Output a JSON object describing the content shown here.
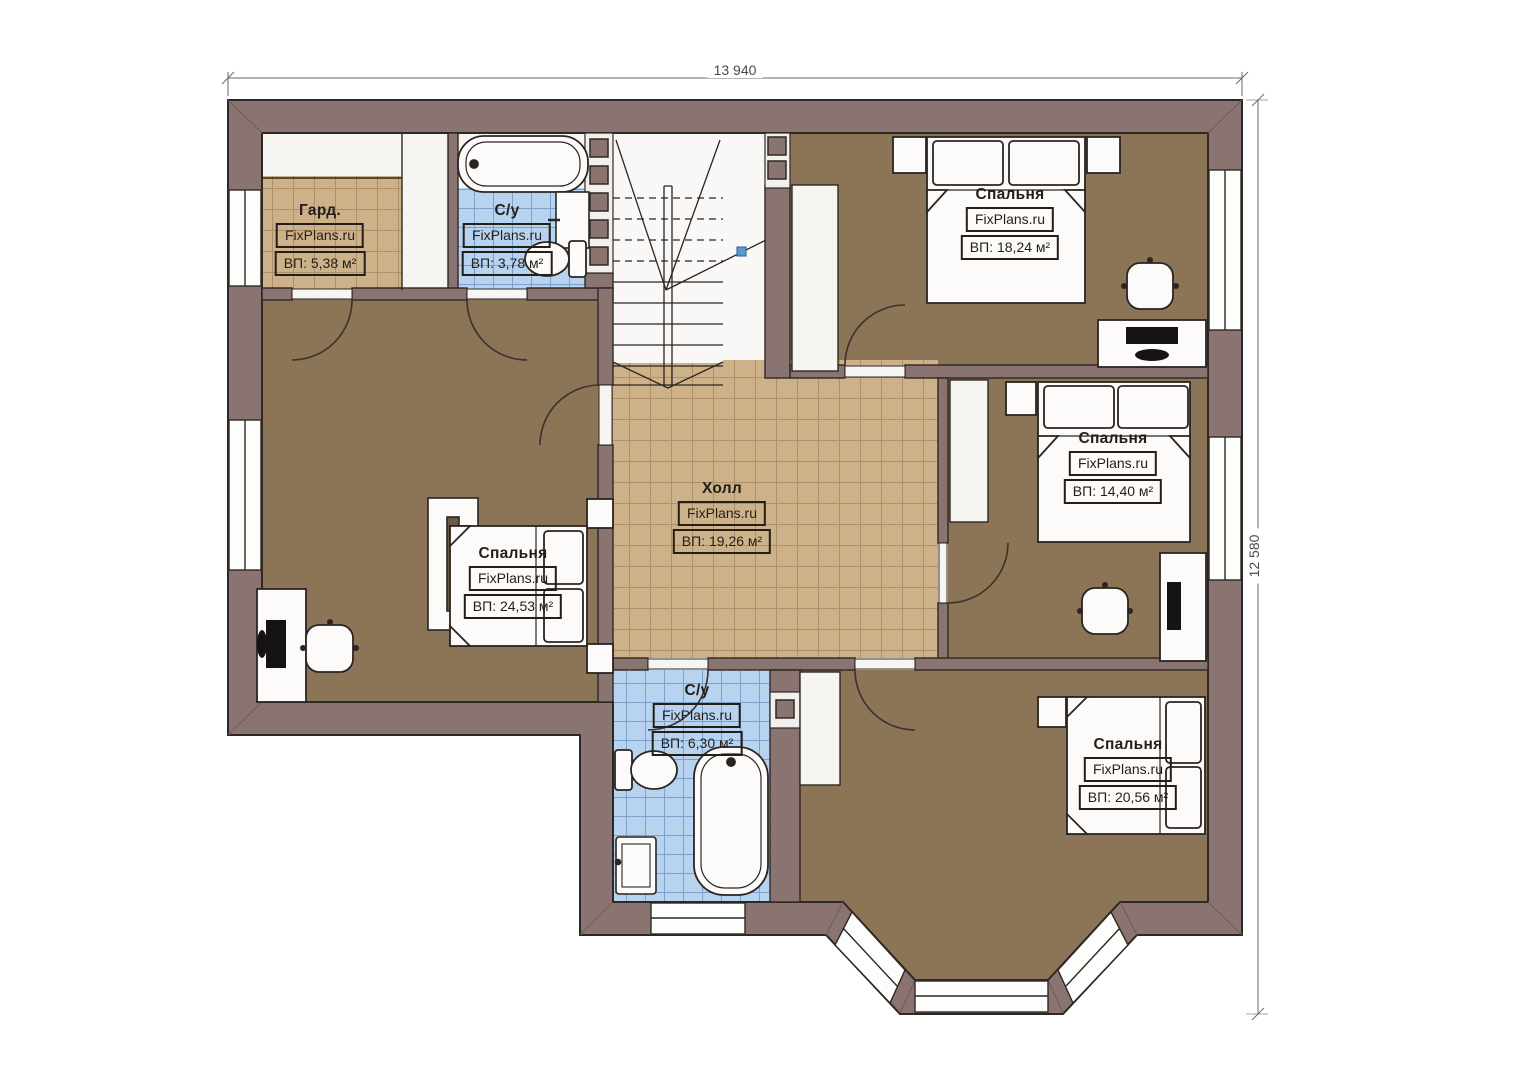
{
  "plan": {
    "watermark": "FixPlans.ru",
    "dimensions": {
      "width": "13 940",
      "height": "12 580"
    },
    "rooms": [
      {
        "name": "Гард.",
        "area": "ВП: 5,38 м²"
      },
      {
        "name": "С/у",
        "area": "ВП: 3,78 м²"
      },
      {
        "name": "Спальня",
        "area": "ВП: 18,24 м²"
      },
      {
        "name": "Спальня",
        "area": "ВП: 14,40 м²"
      },
      {
        "name": "Холл",
        "area": "ВП: 19,26 м²"
      },
      {
        "name": "Спальня",
        "area": "ВП: 24,53 м²"
      },
      {
        "name": "С/у",
        "area": "ВП: 6,30 м²"
      },
      {
        "name": "Спальня",
        "area": "ВП: 20,56 м²"
      }
    ],
    "colors": {
      "wall": "#897471",
      "outline": "#2e2824",
      "tan_floor": "#cdb189",
      "brown_floor": "#8c7457",
      "blue_tile": "#b7d3ef",
      "white_floor": "#f7f5f2",
      "stair_marker_blue": "#5b9bd5"
    }
  }
}
